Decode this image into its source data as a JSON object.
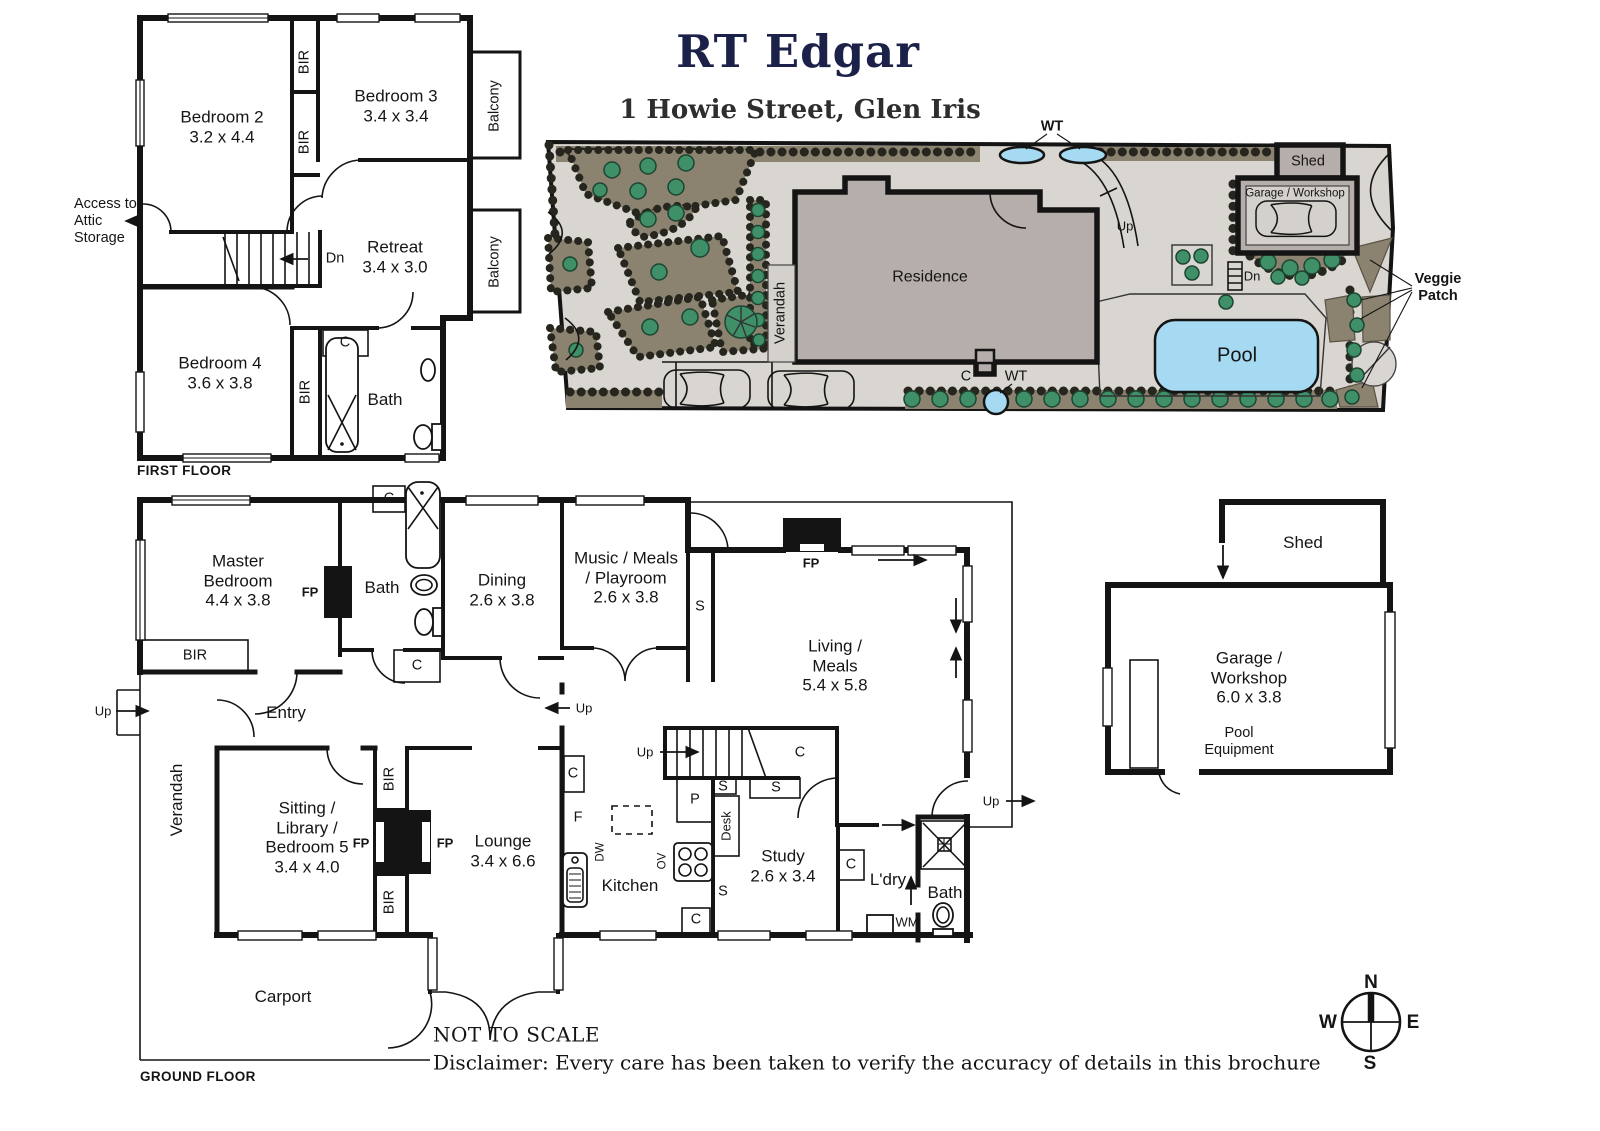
{
  "header": {
    "title": "RT Edgar",
    "subtitle": "1 Howie Street, Glen Iris"
  },
  "ff": {
    "caption": "FIRST FLOOR",
    "bedroom2": {
      "name": "Bedroom 2",
      "dims": "3.2 x 4.4"
    },
    "bedroom3": {
      "name": "Bedroom 3",
      "dims": "3.4 x 3.4"
    },
    "retreat": {
      "name": "Retreat",
      "dims": "3.4 x 3.0"
    },
    "bedroom4": {
      "name": "Bedroom 4",
      "dims": "3.6 x 3.8"
    },
    "bath": "Bath",
    "bir": "BIR",
    "c": "C",
    "dn": "Dn",
    "balcony": "Balcony",
    "attic": "Access to Attic Storage"
  },
  "site": {
    "residence": "Residence",
    "verandah": "Verandah",
    "pool": "Pool",
    "shed": "Shed",
    "garage": "Garage / Workshop",
    "veggie": "Veggie Patch",
    "wt": "WT",
    "c": "C",
    "up": "Up",
    "dn": "Dn"
  },
  "gf": {
    "caption": "GROUND FLOOR",
    "master": {
      "name": "Master Bedroom",
      "dims": "4.4 x 3.8"
    },
    "bath1": "Bath",
    "bath2": "Bath",
    "dining": {
      "name": "Dining",
      "dims": "2.6 x 3.8"
    },
    "music": {
      "name": "Music / Meals / Playroom",
      "dims": "2.6 x 3.8"
    },
    "living": {
      "name": "Living / Meals",
      "dims": "5.4 x 5.8"
    },
    "entry": "Entry",
    "sitting": {
      "name": "Sitting / Library / Bedroom 5",
      "dims": "3.4 x 4.0"
    },
    "lounge": {
      "name": "Lounge",
      "dims": "3.4 x 6.6"
    },
    "kitchen": "Kitchen",
    "study": {
      "name": "Study",
      "dims": "2.6 x 3.4"
    },
    "laundry": "L'dry",
    "carport": "Carport",
    "verandah": "Verandah",
    "bir": "BIR",
    "fp": "FP",
    "c": "C",
    "s": "S",
    "p": "P",
    "f": "F",
    "dw": "DW",
    "ov": "OV",
    "wm": "WM",
    "desk": "Desk",
    "up": "Up"
  },
  "ob": {
    "shed": "Shed",
    "garage": {
      "name": "Garage / Workshop",
      "dims": "6.0 x 3.8"
    },
    "pool_equipment": "Pool Equipment"
  },
  "compass": {
    "n": "N",
    "e": "E",
    "s": "S",
    "w": "W"
  },
  "footer": {
    "not_to_scale": "NOT TO SCALE",
    "disclaimer": "Disclaimer: Every care has been taken to verify the accuracy of details in this brochure"
  },
  "colors": {
    "title_navy": "#1b2149",
    "pool_blue": "#a5daf2",
    "garden_bed": "#8b8370",
    "tree_green": "#3f9068",
    "building_gray": "#b5aeab",
    "ground_gray": "#d9d5d0"
  }
}
